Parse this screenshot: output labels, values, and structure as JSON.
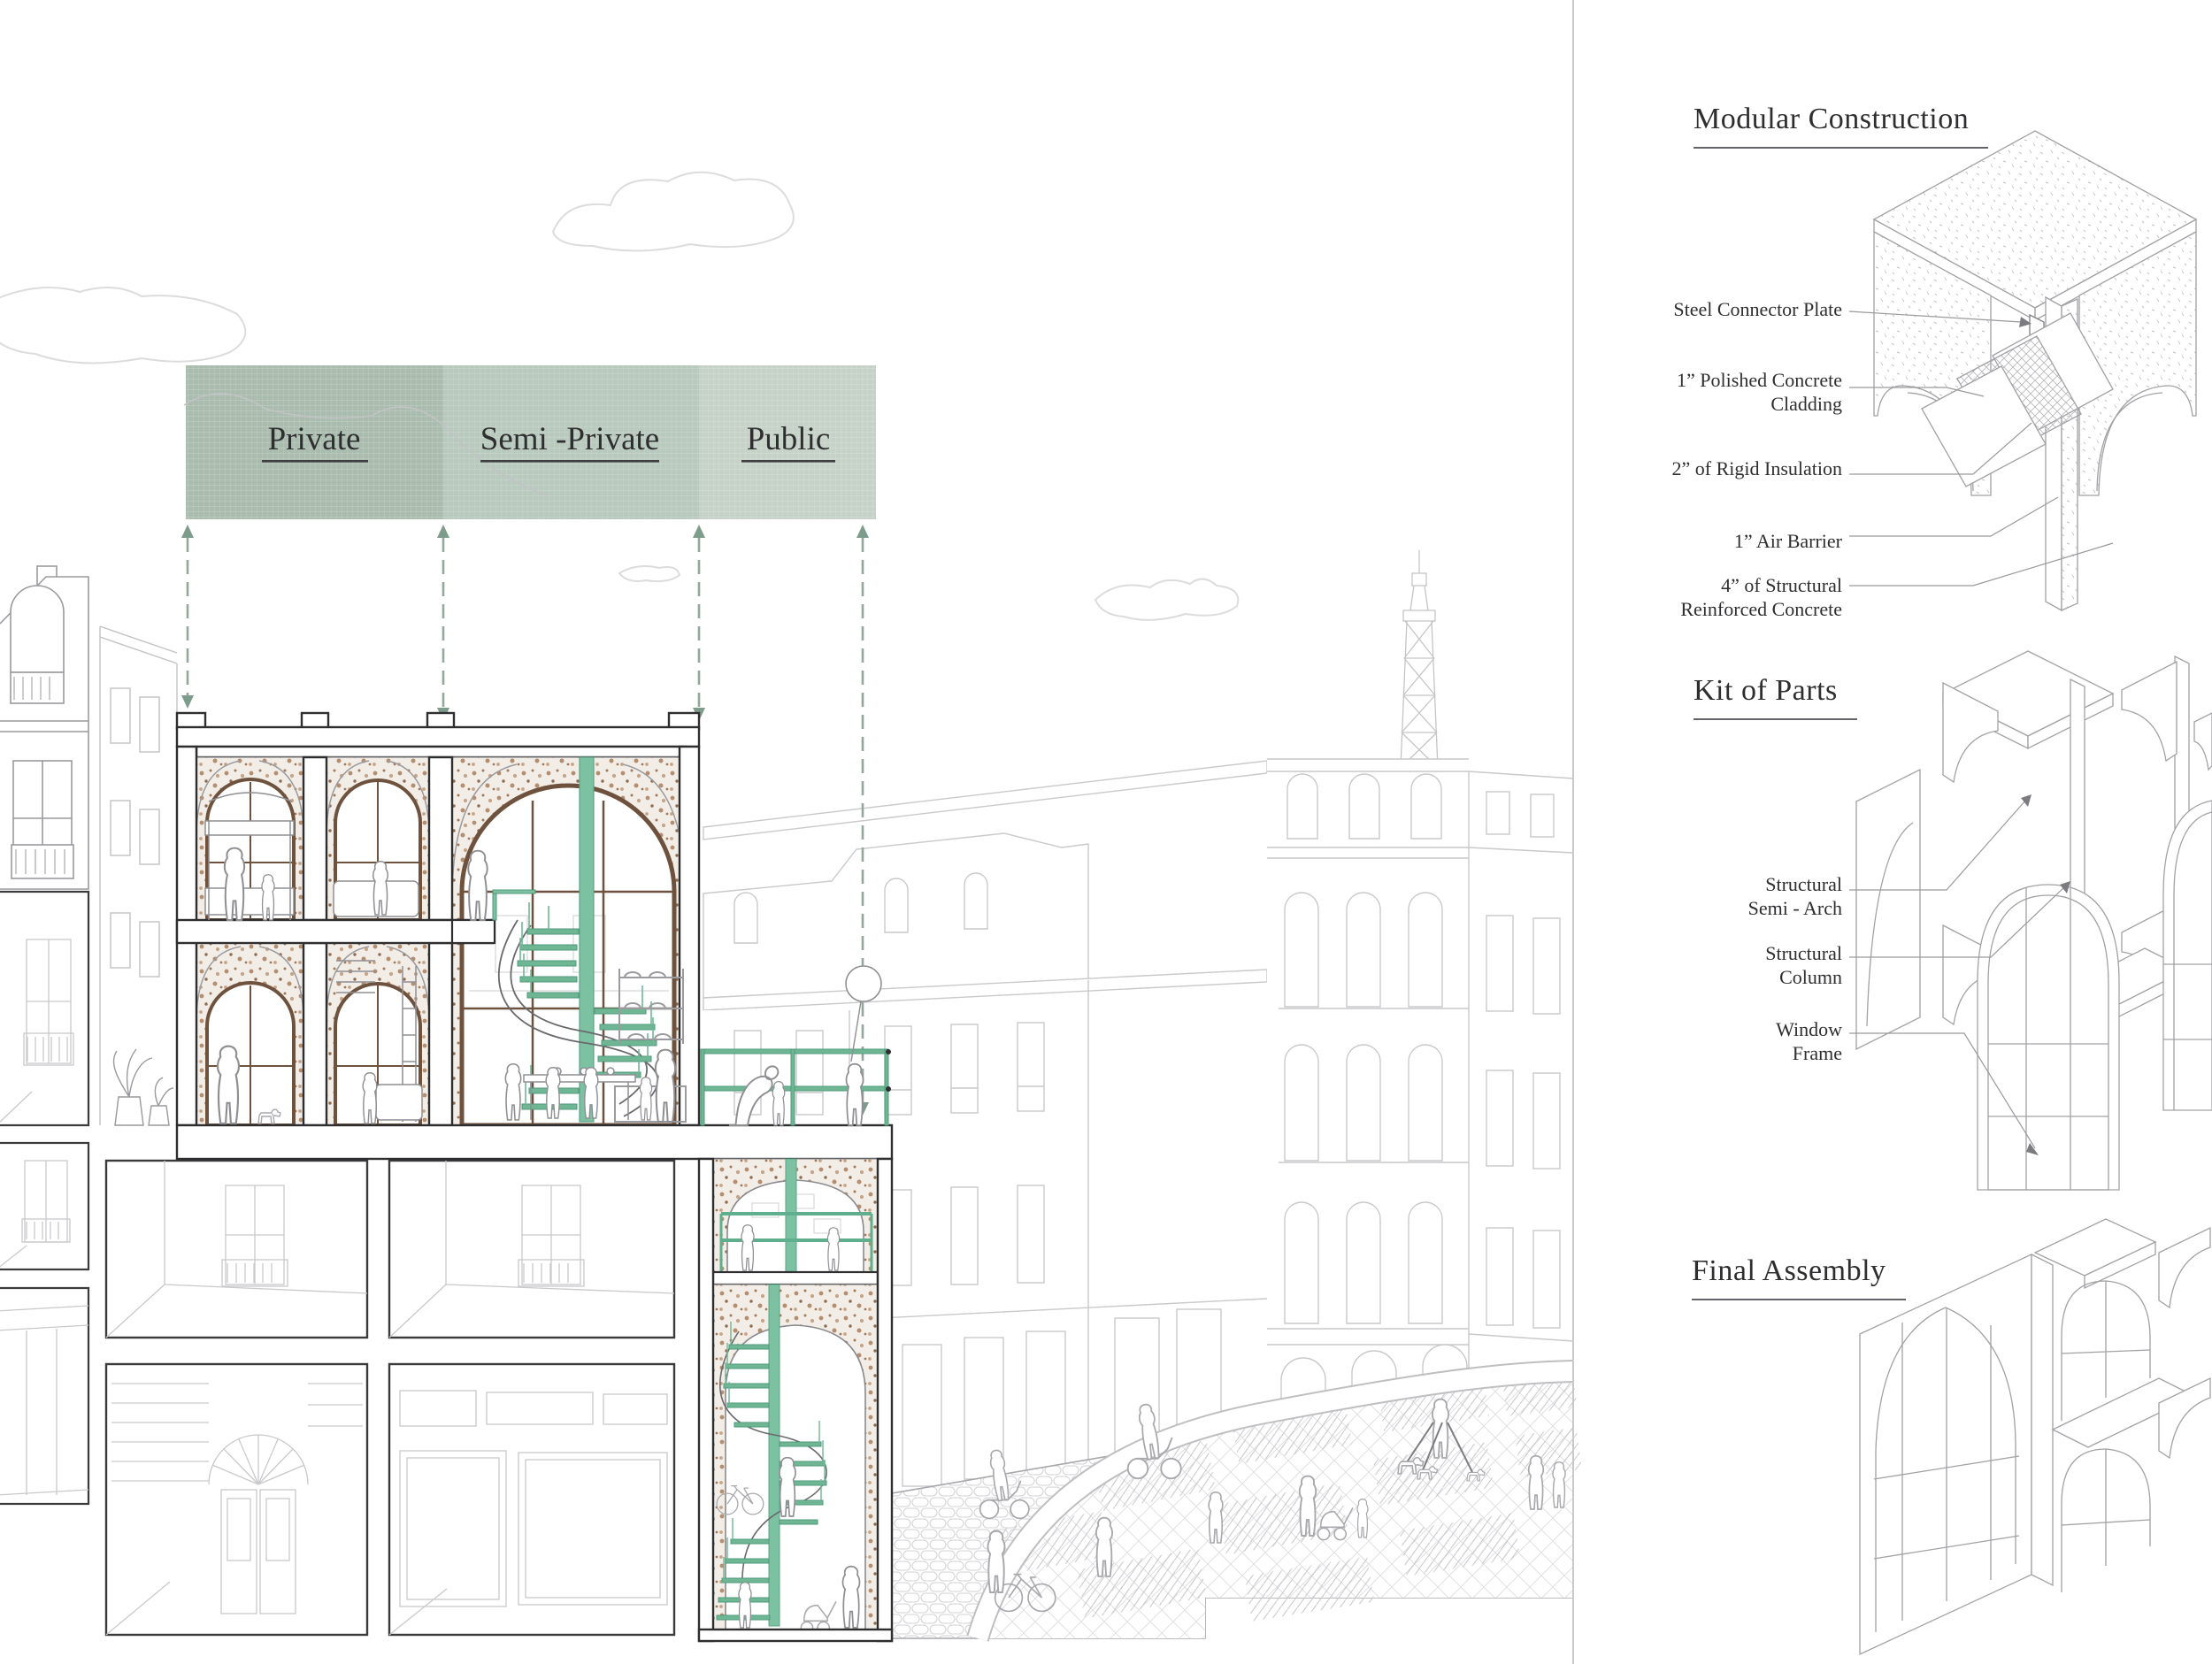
{
  "main": {
    "banner": {
      "sections": [
        {
          "id": "private",
          "label": "Private",
          "color": "#a9bcae"
        },
        {
          "id": "semi_private",
          "label": "Semi -Private",
          "color": "#b8c9bd"
        },
        {
          "id": "public",
          "label": "Public",
          "color": "#c6d2c7"
        }
      ]
    }
  },
  "panels": {
    "modular_construction": {
      "title": "Modular Construction",
      "callouts": [
        "Steel Connector Plate",
        "1” Polished Concrete Cladding",
        "2” of Rigid Insulation",
        "1” Air Barrier",
        "4” of Structural Reinforced Concrete"
      ]
    },
    "kit_of_parts": {
      "title": "Kit of Parts",
      "callouts": [
        "Structural Semi - Arch",
        "Structural Column",
        "Window Frame"
      ]
    },
    "final_assembly": {
      "title": "Final Assembly",
      "callouts": []
    }
  },
  "colors": {
    "accent_green": "#7cc1a2",
    "accent_green_dark": "#4f997c",
    "banner_private": "#a9bcae",
    "banner_semi_private": "#b8c9bd",
    "banner_public": "#c6d2c7",
    "window_frame_brown": "#6e523d",
    "dashed_arrow": "#93a89a",
    "line_light": "#c9c9cc",
    "line_dark": "#2e2e30"
  }
}
